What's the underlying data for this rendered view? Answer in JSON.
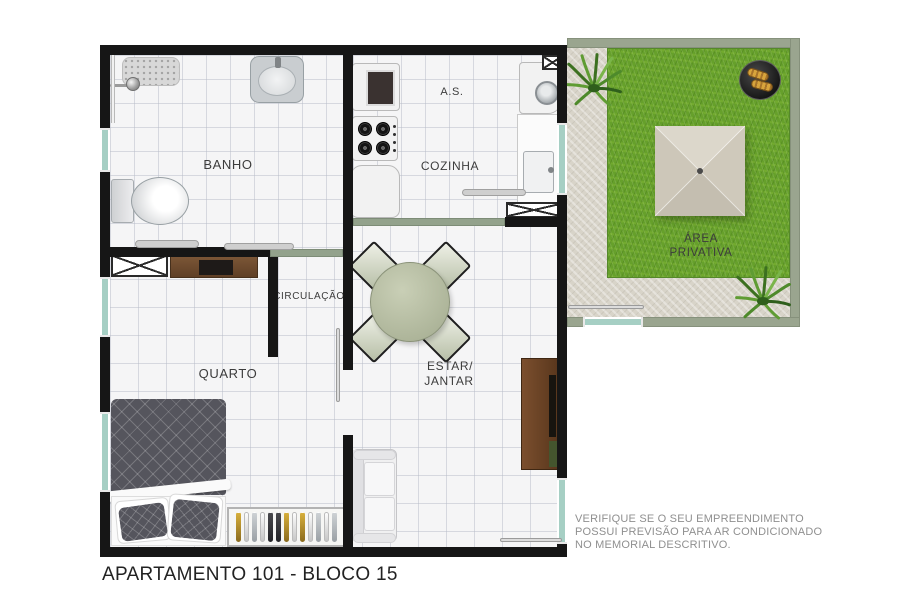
{
  "plan": {
    "title": "APARTAMENTO 101 - BLOCO 15",
    "disclaimer": [
      "VERIFIQUE SE O SEU EMPREENDIMENTO",
      "POSSUI PREVISÃO PARA AR CONDICIONADO",
      "NO MEMORIAL DESCRITIVO."
    ]
  },
  "rooms": {
    "banho": "BANHO",
    "servico": "A.S.",
    "cozinha": "COZINHA",
    "circulacao": "CIRCULAÇÃO",
    "quarto": "QUARTO",
    "estar_line1": "ESTAR/",
    "estar_line2": "JANTAR",
    "area_line1": "ÁREA",
    "area_line2": "PRIVATIVA"
  },
  "colors": {
    "wall": "#161616",
    "window": "#a6cfc4",
    "privativa_border": "#9aa58f",
    "grass": "#66a02b",
    "concrete": "#d8d4c9",
    "floor_tile": "#f5f5f6",
    "umbrella": "#d2ccbf",
    "wood": "#7b4f2e"
  },
  "furniture": {
    "wardrobe_items": [
      "gold",
      "white",
      "silver",
      "white",
      "dark",
      "dark",
      "gold",
      "white",
      "gold",
      "white",
      "silver",
      "white",
      "silver"
    ]
  }
}
